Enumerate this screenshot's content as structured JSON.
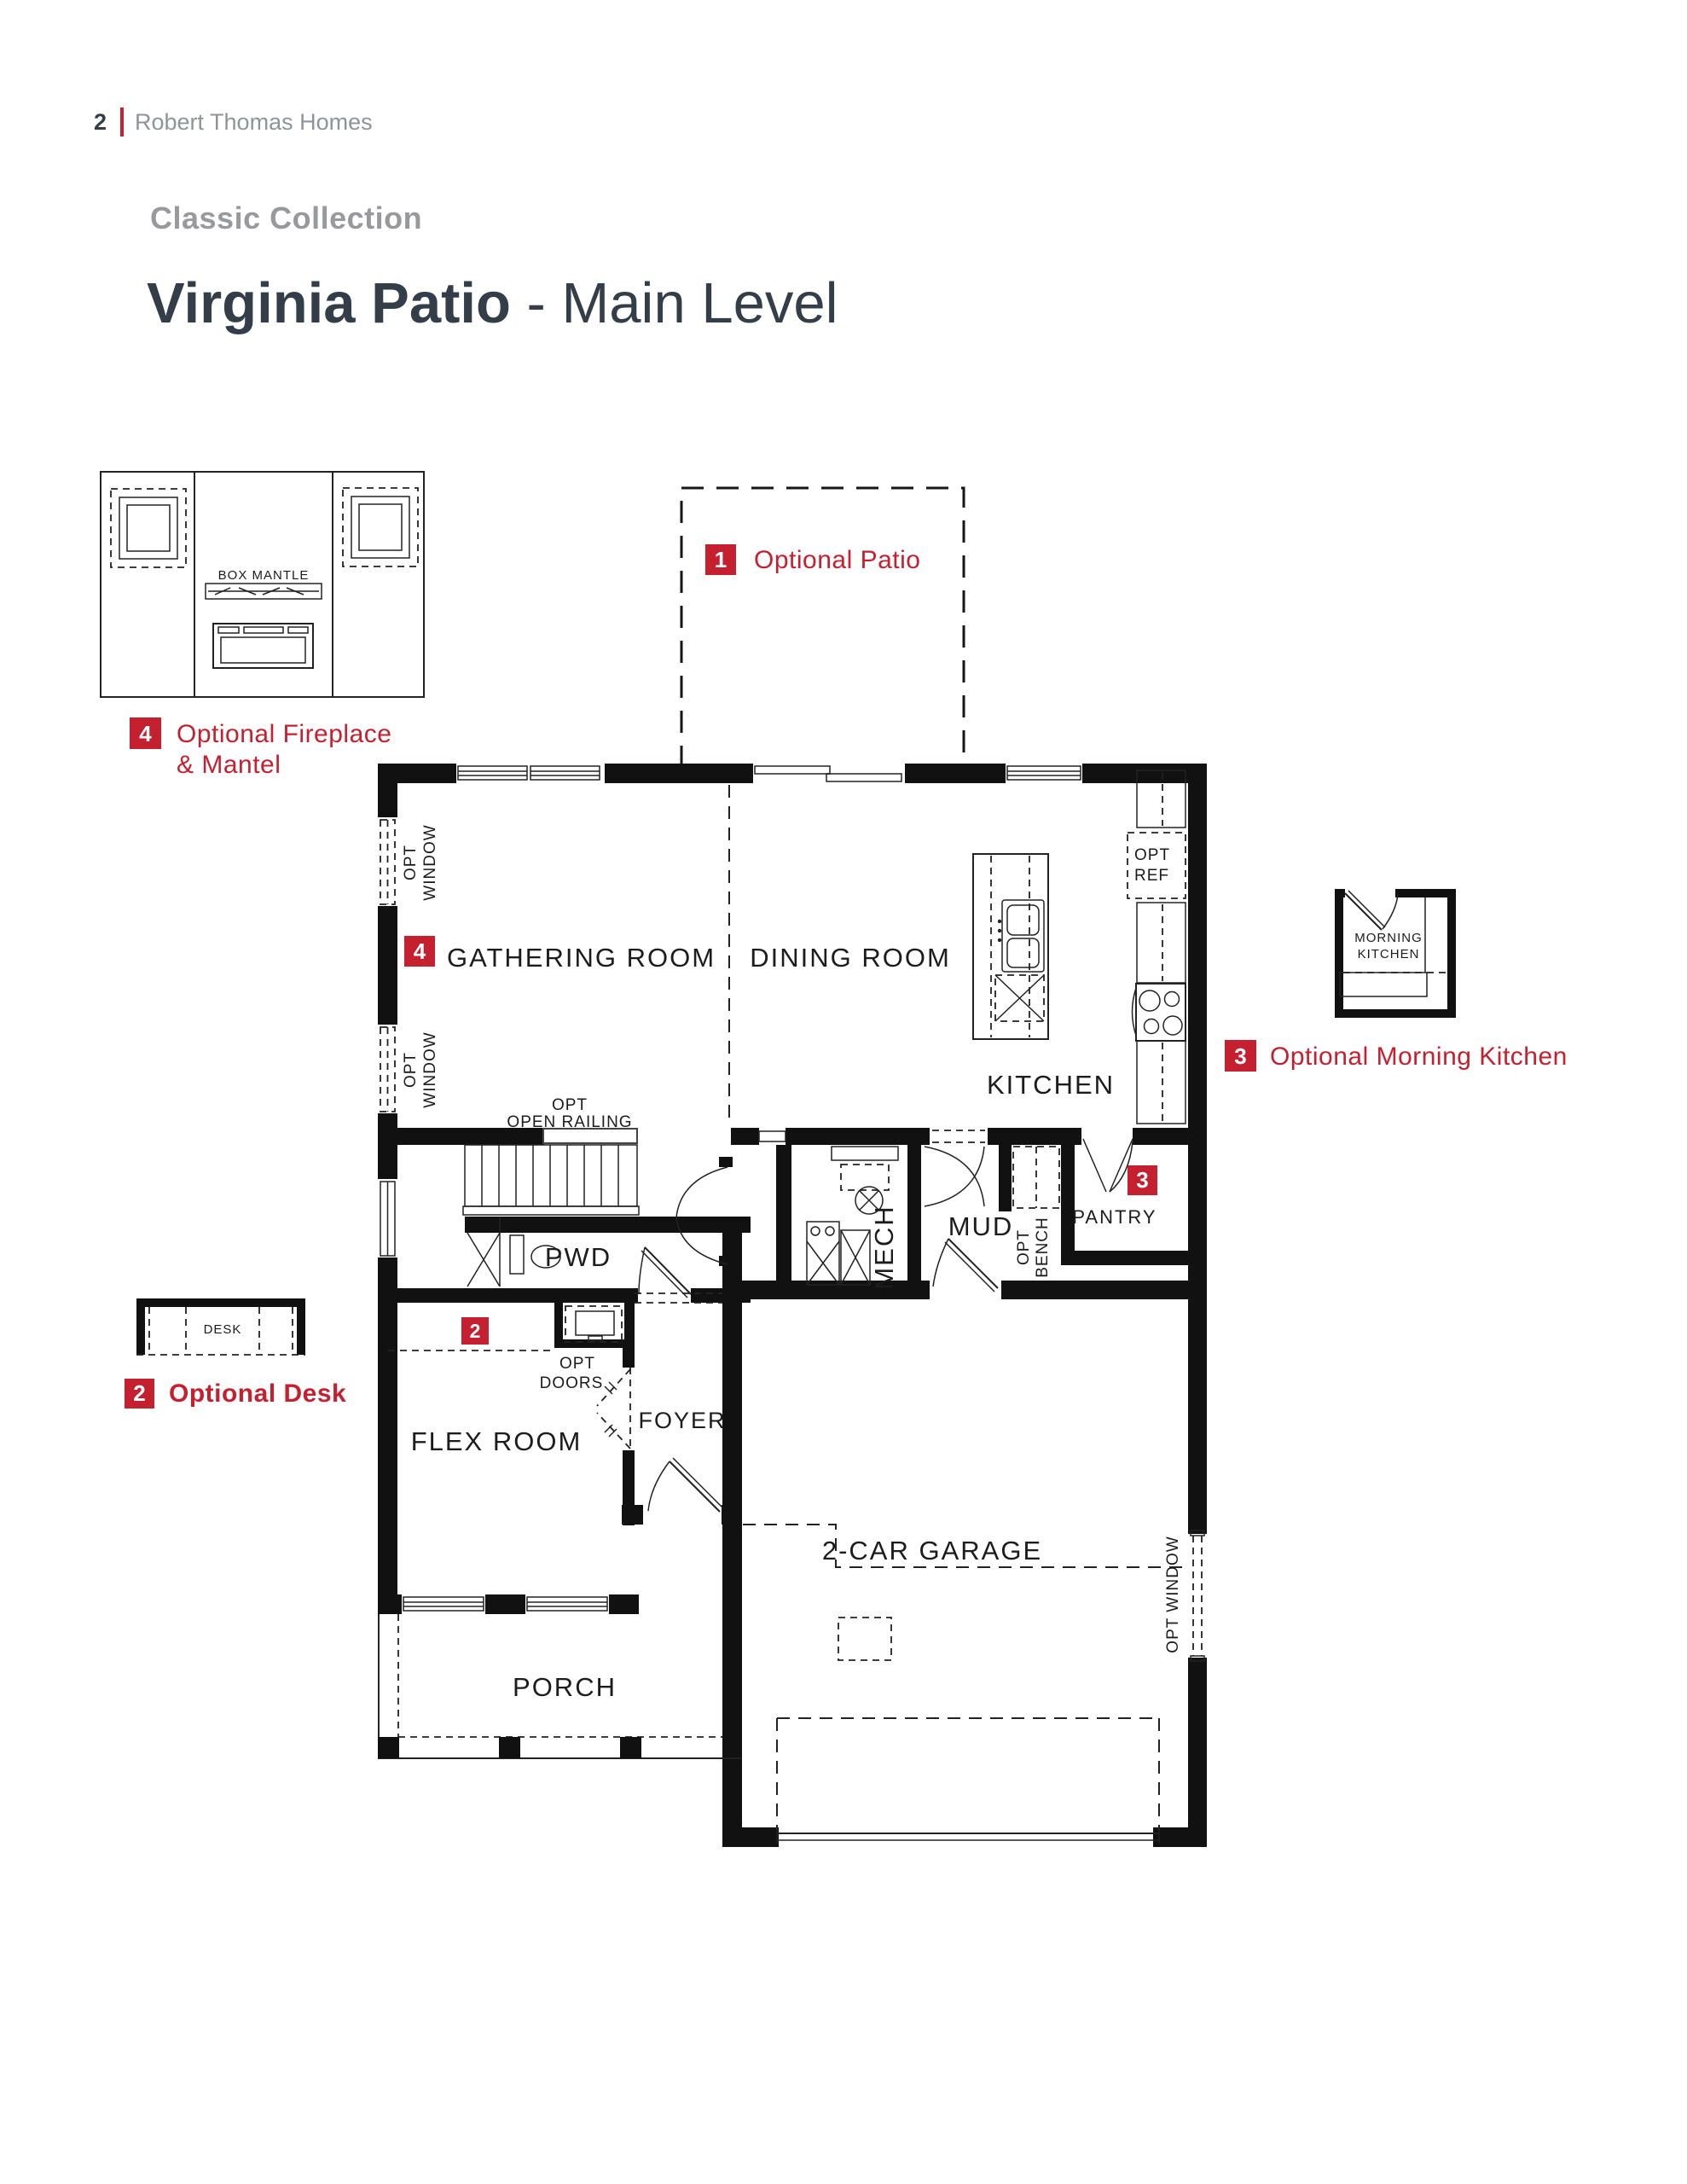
{
  "header": {
    "page_number": "2",
    "brand": "Robert Thomas Homes"
  },
  "title": {
    "collection": "Classic Collection",
    "plan": "Virginia Patio",
    "level": " - Main Level"
  },
  "colors": {
    "red": "#c4202f",
    "dark": "#333e48",
    "gray": "#8f9499",
    "ink": "#1c1c1c"
  },
  "options": {
    "patio": {
      "num": "1",
      "label": "Optional Patio"
    },
    "desk": {
      "num": "2",
      "label": "Optional Desk"
    },
    "morning": {
      "num": "3",
      "label": "Optional Morning Kitchen"
    },
    "fireplace": {
      "num": "4",
      "line1": "Optional Fireplace",
      "line2": "& Mantel"
    }
  },
  "rooms": {
    "gathering": "GATHERING ROOM",
    "dining": "DINING ROOM",
    "kitchen": "KITCHEN",
    "mud": "MUD",
    "mech": "MECH",
    "pwd": "PWD",
    "pantry": "PANTRY",
    "flex": "FLEX ROOM",
    "foyer": "FOYER",
    "garage": "2-CAR GARAGE",
    "porch": "PORCH"
  },
  "ann": {
    "opt": "OPT",
    "window": "WINDOW",
    "opt_window": "OPT WINDOW",
    "open_railing": "OPEN RAILING",
    "ref": "REF",
    "bench": "BENCH",
    "doors": "DOORS",
    "box_mantle": "BOX MANTLE",
    "desk": "DESK",
    "morning": "MORNING",
    "kitchen": "KITCHEN"
  }
}
